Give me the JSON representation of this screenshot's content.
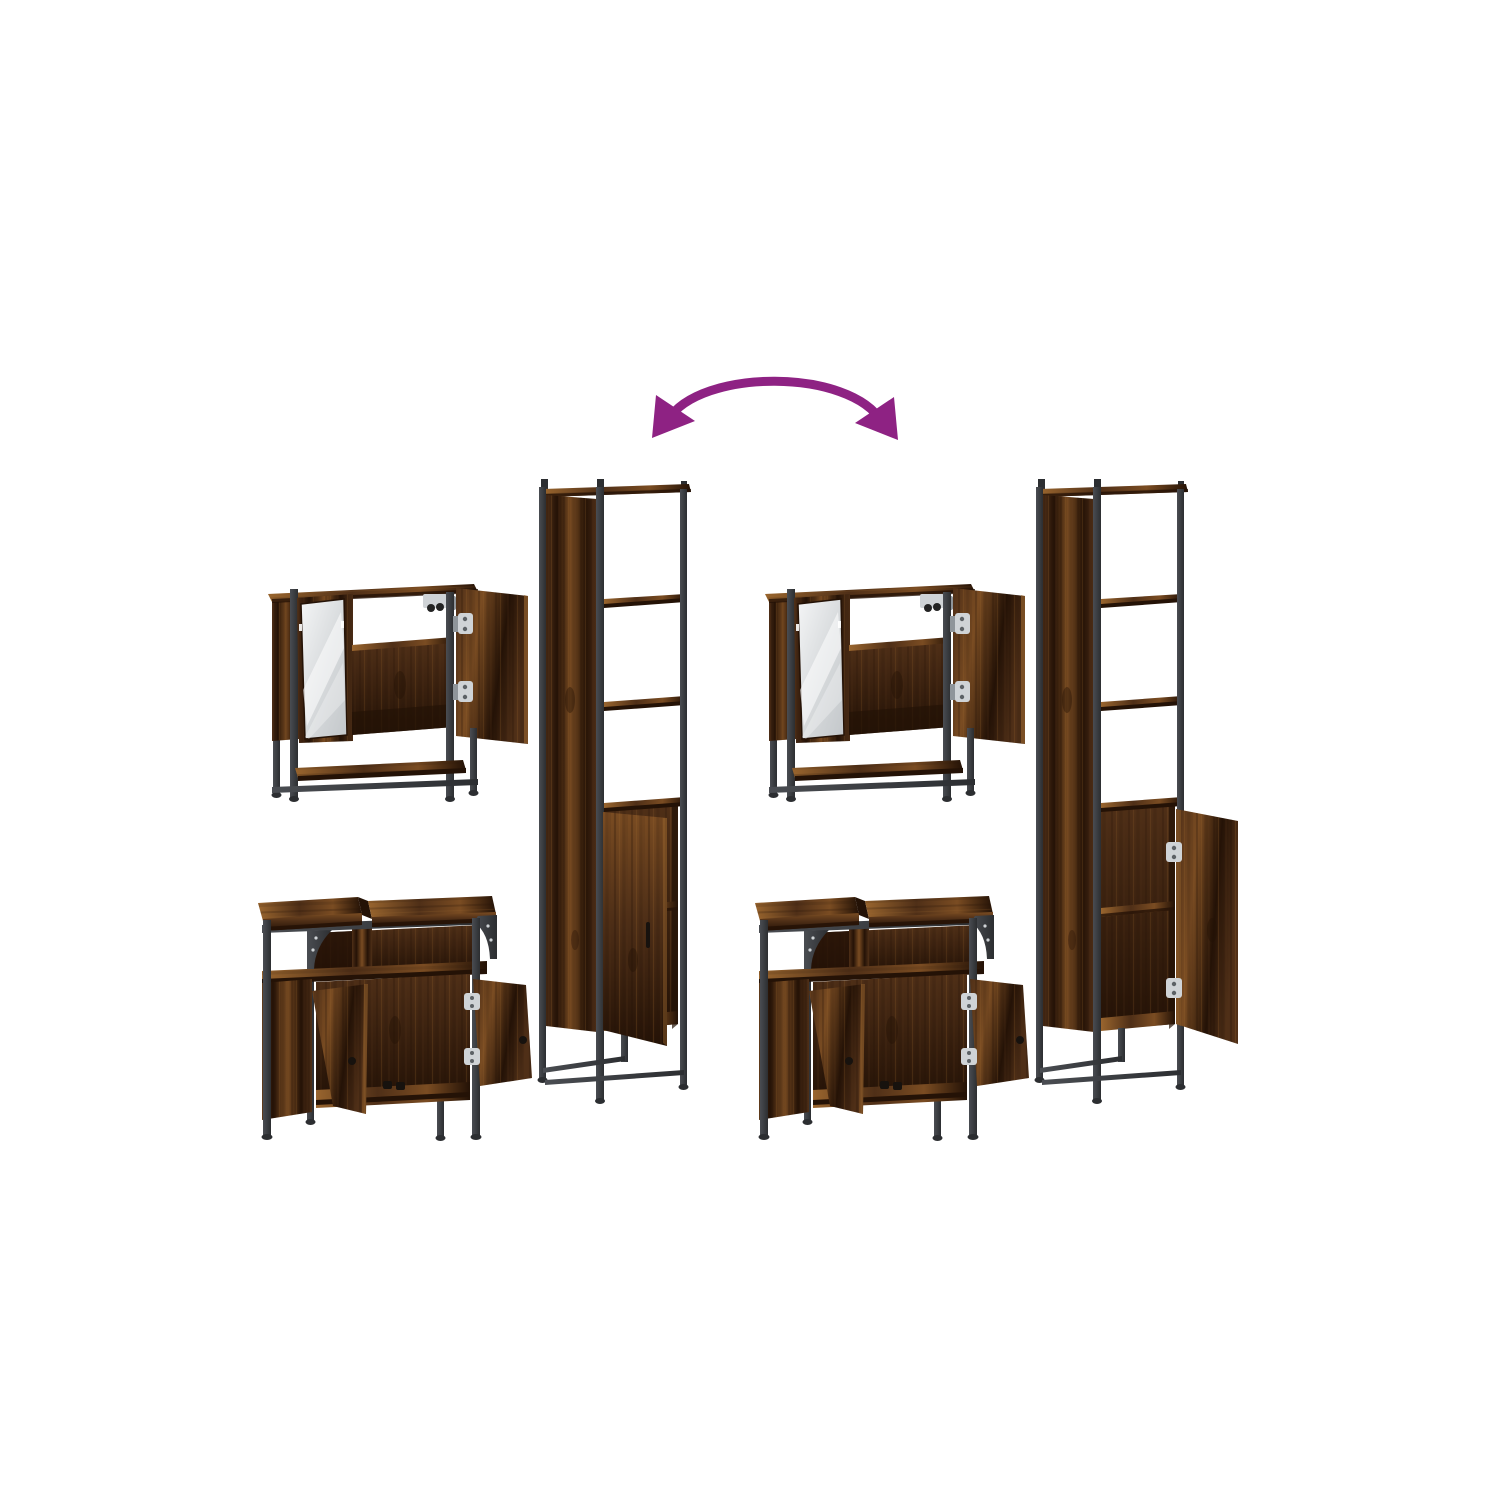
{
  "page": {
    "background": "#ffffff",
    "description": "Product photo of a 3-piece bathroom furniture set in smoked-oak wood with black metal frames, shown as two identical groupings linked by a curved swap arrow"
  },
  "arrow": {
    "name": "swap-arrow",
    "color": "#8e2283",
    "style": "curved double-headed arc pointing to both furniture groups"
  },
  "palette": {
    "background": "#ffffff",
    "arrow_purple": "#8e2283",
    "wood_dark": "#241206",
    "wood_mid": "#4f2f17",
    "wood_light": "#7a4c22",
    "wood_highlight": "#99652e",
    "metal_dark": "#2c2e31",
    "metal_mid": "#4a4d52",
    "mirror_bright": "#f4f5f6",
    "mirror_mid": "#d8dbdd",
    "mirror_dark": "#c3c7ca",
    "hinge_silver": "#cfd3d6",
    "hinge_shadow": "#8f959a",
    "handle_black": "#17120e"
  },
  "pieces": {
    "mirror_cabinet": {
      "label": "bathroom mirror cabinet with open right door and lower shelf"
    },
    "sink_vanity": {
      "label": "bathroom sink vanity cabinet with split top and two open doors"
    },
    "tall_cabinet_left": {
      "label": "tall bathroom cabinet with three open shelves, lower door ajar"
    },
    "tall_cabinet_right": {
      "label": "tall bathroom cabinet with three open shelves, lower door fully open"
    }
  },
  "groups": [
    {
      "id": "left",
      "label": "left furniture arrangement"
    },
    {
      "id": "right",
      "label": "right furniture arrangement"
    }
  ]
}
